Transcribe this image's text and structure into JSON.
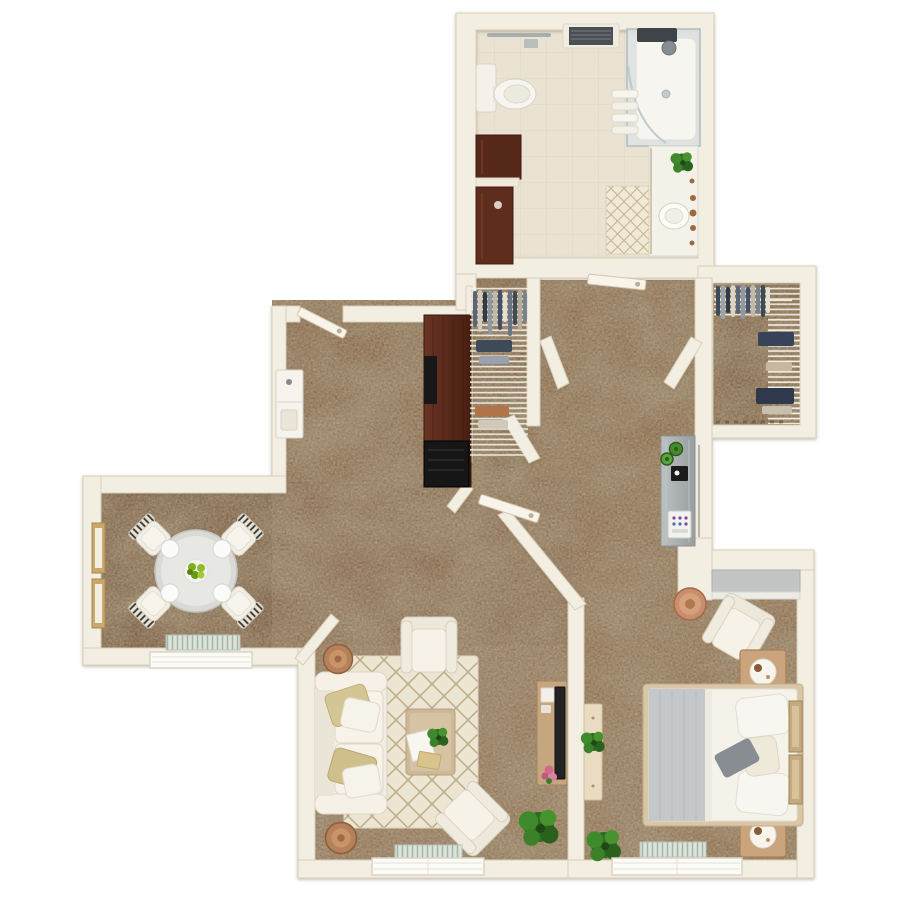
{
  "title": "Top-down 3D rendered apartment floor plan with brown carpet, white walls and staged furniture",
  "meta": {
    "view": "top-down 3D render",
    "background": "#ffffff",
    "visible_text": "none"
  },
  "palette": {
    "wall": "#f3eee2",
    "wall_edge": "#d9d0ba",
    "carpet": "#8a6d4e",
    "carpet_dining": "#73573c",
    "carpet_mottle": "#4d3a26",
    "bathroom_tile": "#eae4d5",
    "grout": "#dfd8c6",
    "rug": "#ece5d2",
    "rug_lattice": "#b9a887",
    "upholstery_white": "#f4f0e6",
    "pillow_tan": "#d2c292",
    "wood_dark": "#5a2b1c",
    "wood_light": "#c9a47c",
    "wood_mid": "#b5815c",
    "counter_gray": "#a8acae",
    "blanket_gray": "#c4c8cb",
    "plant_green": "#3f8a2c",
    "terracotta": "#c98e6b",
    "vent": "#dce3da",
    "tv_black": "#1d1d1d",
    "flower_pink": "#d4688c",
    "clock_bronze": "#8a5a34",
    "fruit_green": "#8fbd2a"
  },
  "rooms": [
    {
      "id": "bathroom",
      "name": "bathroom",
      "furniture": [
        "toilet",
        "walk-in-glass-shower",
        "shower-fixture",
        "towel-rack",
        "towel-bar",
        "ceiling-vent",
        "dark-wood-cabinets",
        "vanity-with-sink",
        "faucet-knobs",
        "potted-plant",
        "diamond-bath-mat",
        "door-leaf"
      ]
    },
    {
      "id": "den",
      "name": "den-office",
      "furniture": [
        "entry-door-leaf",
        "white-console-table",
        "dark-media-wardrobe",
        "tv-panel",
        "wire-shelf-closet",
        "hanging-clothes"
      ]
    },
    {
      "id": "walk_in_closet",
      "name": "walk-in-closet",
      "furniture": [
        "clothes-rod",
        "hanging-clothes",
        "wire-shelving",
        "folded-clothes-piles"
      ]
    },
    {
      "id": "hallway",
      "name": "hallway",
      "furniture": [
        "bathroom-door-leaf",
        "entry-door-leaf",
        "splayed-door-jambs",
        "angled-walls"
      ]
    },
    {
      "id": "kitchen",
      "name": "kitchenette",
      "furniture": [
        "gray-counter",
        "two-succulent-plants",
        "black-cooktop",
        "small-white-appliance"
      ]
    },
    {
      "id": "dining",
      "name": "dining-area",
      "furniture": [
        "round-dining-table",
        "four-striped-chairs",
        "four-place-settings",
        "green-centerpiece",
        "two-wall-artworks",
        "baseboard-vent",
        "window"
      ]
    },
    {
      "id": "living",
      "name": "living-room",
      "furniture": [
        "three-seat-sofa",
        "two-tan-pillows",
        "two-round-side-tables",
        "armchair",
        "corner-armchair",
        "diamond-area-rug",
        "wood-coffee-table",
        "coffee-table-plant",
        "papers-and-book",
        "media-console",
        "tv-bar",
        "pink-flowers",
        "potted-plant",
        "baseboard-vent",
        "window"
      ]
    },
    {
      "id": "bedroom",
      "name": "bedroom",
      "furniture": [
        "queen-bed",
        "gray-folded-blanket",
        "white-pillows",
        "two-nightstands",
        "round-clock-trays",
        "gray-dresser",
        "armchair",
        "terracotta-side-table",
        "two-wall-wood-panels",
        "slim-dresser",
        "dresser-plant",
        "floor-plant",
        "baseboard-vent",
        "window"
      ]
    }
  ],
  "counts": {
    "rooms": 8,
    "doors": 3,
    "windows": 3,
    "plants": 7,
    "closets": 2
  }
}
